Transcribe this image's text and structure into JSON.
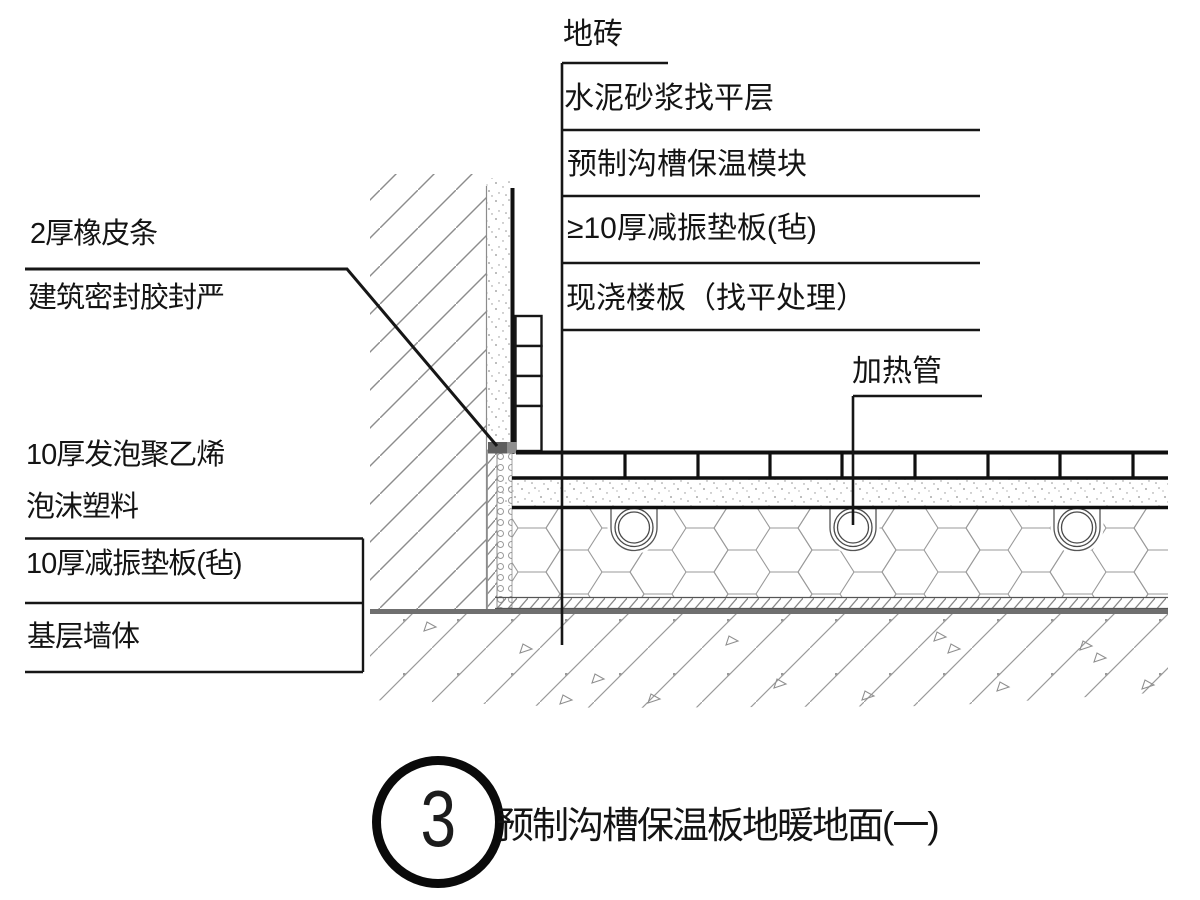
{
  "colors": {
    "ink": "#141414",
    "heavy_line": "#0f0f0f",
    "slab_gray": "#6f6f6f",
    "hatch_gray": "#8c8c8c"
  },
  "callouts_right": [
    {
      "id": "floor-tile",
      "label": "地砖"
    },
    {
      "id": "cement-mortar-leveling",
      "label": "水泥砂浆找平层"
    },
    {
      "id": "precast-groove-module",
      "label": "预制沟槽保温模块"
    },
    {
      "id": "damping-pad-felt",
      "label": "≥10厚减振垫板(毡)"
    },
    {
      "id": "cast-in-place-slab",
      "label": "现浇楼板（找平处理）"
    },
    {
      "id": "heating-pipe",
      "label": "加热管"
    }
  ],
  "callouts_left": [
    {
      "id": "rubber-strip",
      "label": "2厚橡皮条"
    },
    {
      "id": "sealant",
      "label": "建筑密封胶封严"
    },
    {
      "id": "pe-foam-line1",
      "label": "10厚发泡聚乙烯"
    },
    {
      "id": "pe-foam-line2",
      "label": "泡沫塑料"
    },
    {
      "id": "damping-pad-wall",
      "label": "10厚减振垫板(毡)"
    },
    {
      "id": "base-wall",
      "label": "基层墙体"
    }
  ],
  "title_block": {
    "detail_number": "3",
    "title": "预制沟槽保温板地暖地面(一)"
  }
}
